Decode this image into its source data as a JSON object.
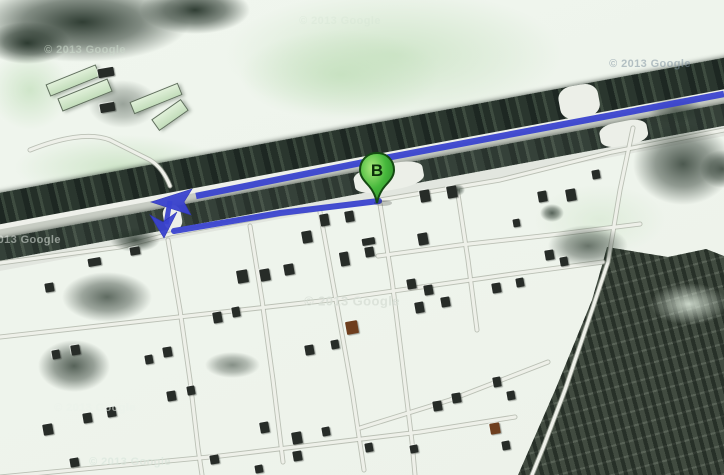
{
  "map": {
    "marker": {
      "label": "B",
      "color": "#3fae3c"
    },
    "route": {
      "color": "#3a43cf"
    },
    "watermark_text": "© 2013 Google",
    "watermark_center_text": "© 2013 Google"
  }
}
